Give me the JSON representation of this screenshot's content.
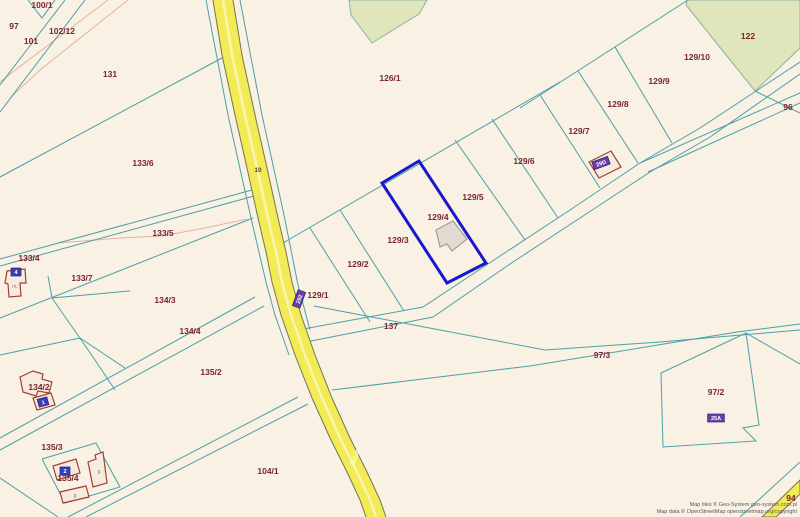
{
  "canvas": {
    "width": 800,
    "height": 517
  },
  "colors": {
    "background": "#f8f1e4",
    "parcel_line": "#4aa0a8",
    "path_line": "#e4b2a2",
    "road_fill": "#f2eb55",
    "road_edge": "#76764f",
    "road_center": "#f9f5b0",
    "label": "#7b2433",
    "highlight": "#1818cc",
    "green_fill": "#e1e5bc",
    "green_edge": "#8ab4a0",
    "building_gray_fill": "#e0dcd4",
    "building_gray_edge": "#a59c90",
    "building_red_fill": "#f7ebdf",
    "building_red_edge": "#a04030",
    "badge_blue": "#3a3fb8",
    "badge_purple": "#6b3fa8"
  },
  "parcel_labels": [
    {
      "text": "100/1",
      "x": 42,
      "y": 5
    },
    {
      "text": "97",
      "x": 14,
      "y": 26
    },
    {
      "text": "102/12",
      "x": 62,
      "y": 31
    },
    {
      "text": "101",
      "x": 31,
      "y": 41
    },
    {
      "text": "131",
      "x": 110,
      "y": 74
    },
    {
      "text": "126/1",
      "x": 390,
      "y": 78
    },
    {
      "text": "122",
      "x": 748,
      "y": 36
    },
    {
      "text": "129/10",
      "x": 697,
      "y": 57
    },
    {
      "text": "129/9",
      "x": 659,
      "y": 81
    },
    {
      "text": "129/8",
      "x": 618,
      "y": 104
    },
    {
      "text": "96",
      "x": 788,
      "y": 107
    },
    {
      "text": "129/7",
      "x": 579,
      "y": 131
    },
    {
      "text": "133/6",
      "x": 143,
      "y": 163
    },
    {
      "text": "129/6",
      "x": 524,
      "y": 161
    },
    {
      "text": "129/5",
      "x": 473,
      "y": 197
    },
    {
      "text": "129/4",
      "x": 438,
      "y": 217
    },
    {
      "text": "133/5",
      "x": 163,
      "y": 233
    },
    {
      "text": "129/3",
      "x": 398,
      "y": 240
    },
    {
      "text": "133/4",
      "x": 29,
      "y": 258
    },
    {
      "text": "129/2",
      "x": 358,
      "y": 264
    },
    {
      "text": "133/7",
      "x": 82,
      "y": 278
    },
    {
      "text": "129/1",
      "x": 318,
      "y": 295
    },
    {
      "text": "134/3",
      "x": 165,
      "y": 300
    },
    {
      "text": "137",
      "x": 391,
      "y": 326
    },
    {
      "text": "134/4",
      "x": 190,
      "y": 331
    },
    {
      "text": "97/3",
      "x": 602,
      "y": 355
    },
    {
      "text": "135/2",
      "x": 211,
      "y": 372
    },
    {
      "text": "134/2",
      "x": 39,
      "y": 387
    },
    {
      "text": "97/2",
      "x": 716,
      "y": 392
    },
    {
      "text": "135/3",
      "x": 52,
      "y": 447
    },
    {
      "text": "104/1",
      "x": 268,
      "y": 471
    },
    {
      "text": "135/4",
      "x": 68,
      "y": 478
    },
    {
      "text": "94",
      "x": 791,
      "y": 498
    }
  ],
  "road_labels": [
    {
      "text": "10",
      "x": 258,
      "y": 172,
      "rot": 0,
      "color": "#4a3f2f"
    },
    {
      "text": "101/4",
      "x": 357,
      "y": 459,
      "rot": -65,
      "color": "#fdfdf2"
    }
  ],
  "badges": [
    {
      "text": "4",
      "x": 16,
      "y": 272,
      "type": "blue",
      "rot": 0
    },
    {
      "text": "1",
      "x": 43,
      "y": 402,
      "type": "blue",
      "rot": -15
    },
    {
      "text": "2",
      "x": 65,
      "y": 471,
      "type": "blue",
      "rot": 0
    },
    {
      "text": "292",
      "x": 299,
      "y": 299,
      "type": "purple",
      "rot": -70
    },
    {
      "text": "29D",
      "x": 601,
      "y": 163,
      "type": "purple",
      "rot": -20
    },
    {
      "text": "25A",
      "x": 716,
      "y": 418,
      "type": "purple",
      "rot": 0
    }
  ],
  "building_letters": [
    {
      "text": "m.",
      "x": 15,
      "y": 288
    },
    {
      "text": "g",
      "x": 99,
      "y": 473
    },
    {
      "text": "g",
      "x": 75,
      "y": 497
    }
  ],
  "green_areas": [
    [
      [
        349,
        0
      ],
      [
        427,
        0
      ],
      [
        419,
        14
      ],
      [
        372,
        43
      ],
      [
        351,
        15
      ]
    ],
    [
      [
        687,
        0
      ],
      [
        800,
        0
      ],
      [
        800,
        48
      ],
      [
        755,
        91
      ],
      [
        686,
        5
      ]
    ]
  ],
  "teal_lines": [
    [
      [
        28,
        0
      ],
      [
        42,
        18
      ],
      [
        55,
        0
      ]
    ],
    [
      [
        65,
        0
      ],
      [
        0,
        85
      ]
    ],
    [
      [
        85,
        0
      ],
      [
        0,
        112
      ]
    ],
    [
      [
        222,
        58
      ],
      [
        0,
        177
      ]
    ],
    [
      [
        252,
        190
      ],
      [
        0,
        259
      ]
    ],
    [
      [
        254,
        196
      ],
      [
        0,
        266
      ]
    ],
    [
      [
        253,
        218
      ],
      [
        0,
        318
      ]
    ],
    [
      [
        48,
        276
      ],
      [
        52,
        298
      ]
    ],
    [
      [
        52,
        298
      ],
      [
        130,
        291
      ]
    ],
    [
      [
        52,
        298
      ],
      [
        93,
        357
      ],
      [
        115,
        390
      ]
    ],
    [
      [
        0,
        438
      ],
      [
        255,
        297
      ]
    ],
    [
      [
        0,
        450
      ],
      [
        264,
        306
      ]
    ],
    [
      [
        0,
        355
      ],
      [
        80,
        338
      ]
    ],
    [
      [
        80,
        338
      ],
      [
        125,
        368
      ]
    ],
    [
      [
        68,
        517
      ],
      [
        298,
        397
      ]
    ],
    [
      [
        86,
        517
      ],
      [
        308,
        404
      ]
    ],
    [
      [
        0,
        478
      ],
      [
        58,
        517
      ]
    ],
    [
      [
        42,
        459
      ],
      [
        96,
        443
      ],
      [
        120,
        487
      ],
      [
        65,
        503
      ],
      [
        42,
        459
      ]
    ],
    [
      [
        298,
        330
      ],
      [
        423,
        307
      ],
      [
        500,
        256
      ],
      [
        570,
        210
      ],
      [
        640,
        163
      ],
      [
        700,
        128
      ],
      [
        800,
        62
      ]
    ],
    [
      [
        306,
        342
      ],
      [
        433,
        317
      ],
      [
        510,
        264
      ],
      [
        580,
        218
      ],
      [
        650,
        172
      ],
      [
        710,
        137
      ],
      [
        800,
        74
      ]
    ],
    [
      [
        640,
        163
      ],
      [
        800,
        93
      ]
    ],
    [
      [
        648,
        172
      ],
      [
        800,
        103
      ]
    ],
    [
      [
        314,
        306
      ],
      [
        440,
        330
      ],
      [
        545,
        350
      ],
      [
        660,
        342
      ],
      [
        800,
        330
      ]
    ],
    [
      [
        332,
        390
      ],
      [
        530,
        366
      ],
      [
        737,
        332
      ],
      [
        800,
        324
      ]
    ],
    [
      [
        661,
        373
      ],
      [
        746,
        333
      ],
      [
        759,
        425
      ],
      [
        743,
        428
      ],
      [
        756,
        441
      ],
      [
        663,
        447
      ],
      [
        661,
        373
      ]
    ],
    [
      [
        746,
        333
      ],
      [
        800,
        364
      ]
    ],
    [
      [
        283,
        243
      ],
      [
        560,
        82
      ]
    ],
    [
      [
        520,
        108
      ],
      [
        688,
        0
      ]
    ],
    [
      [
        310,
        228
      ],
      [
        370,
        322
      ]
    ],
    [
      [
        340,
        210
      ],
      [
        404,
        311
      ]
    ],
    [
      [
        455,
        140
      ],
      [
        525,
        240
      ]
    ],
    [
      [
        492,
        119
      ],
      [
        558,
        218
      ]
    ],
    [
      [
        540,
        95
      ],
      [
        600,
        188
      ]
    ],
    [
      [
        578,
        71
      ],
      [
        638,
        163
      ]
    ],
    [
      [
        615,
        47
      ],
      [
        672,
        143
      ]
    ],
    [
      [
        206,
        0
      ],
      [
        228,
        115
      ],
      [
        251,
        218
      ],
      [
        266,
        282
      ],
      [
        275,
        315
      ],
      [
        289,
        355
      ]
    ],
    [
      [
        240,
        0
      ],
      [
        262,
        115
      ],
      [
        284,
        215
      ],
      [
        298,
        285
      ],
      [
        310,
        330
      ]
    ],
    [
      [
        755,
        91
      ],
      [
        800,
        113
      ]
    ],
    [
      [
        740,
        517
      ],
      [
        800,
        462
      ]
    ]
  ],
  "pink_lines": [
    [
      [
        108,
        0
      ],
      [
        18,
        68
      ],
      [
        0,
        82
      ]
    ],
    [
      [
        128,
        0
      ],
      [
        40,
        70
      ],
      [
        10,
        98
      ]
    ],
    [
      [
        58,
        243
      ],
      [
        120,
        238
      ],
      [
        162,
        236
      ],
      [
        205,
        228
      ],
      [
        247,
        219
      ]
    ]
  ],
  "road": {
    "left": [
      [
        213,
        0
      ],
      [
        222,
        55
      ],
      [
        235,
        115
      ],
      [
        247,
        168
      ],
      [
        258,
        218
      ],
      [
        266,
        252
      ],
      [
        272,
        282
      ],
      [
        281,
        315
      ],
      [
        295,
        355
      ],
      [
        312,
        398
      ],
      [
        330,
        438
      ],
      [
        347,
        472
      ],
      [
        360,
        500
      ],
      [
        366,
        517
      ]
    ],
    "right": [
      [
        233,
        0
      ],
      [
        242,
        55
      ],
      [
        255,
        115
      ],
      [
        267,
        168
      ],
      [
        278,
        218
      ],
      [
        286,
        252
      ],
      [
        292,
        282
      ],
      [
        301,
        315
      ],
      [
        315,
        355
      ],
      [
        332,
        398
      ],
      [
        350,
        438
      ],
      [
        367,
        472
      ],
      [
        380,
        500
      ],
      [
        386,
        517
      ]
    ]
  },
  "corner_road": [
    [
      762,
      517
    ],
    [
      800,
      480
    ],
    [
      800,
      494
    ],
    [
      776,
      517
    ]
  ],
  "highlight_parcel": [
    [
      382,
      183
    ],
    [
      419,
      161
    ],
    [
      486,
      263
    ],
    [
      447,
      283
    ]
  ],
  "buildings": [
    {
      "style": "gray",
      "points": [
        [
          436,
          230
        ],
        [
          453,
          221
        ],
        [
          467,
          239
        ],
        [
          452,
          251
        ],
        [
          447,
          244
        ],
        [
          440,
          247
        ]
      ]
    },
    {
      "style": "red",
      "points": [
        [
          589,
          162
        ],
        [
          611,
          151
        ],
        [
          621,
          167
        ],
        [
          599,
          178
        ]
      ]
    },
    {
      "style": "red",
      "points": [
        [
          7,
          271
        ],
        [
          25,
          269
        ],
        [
          26,
          283
        ],
        [
          20,
          283
        ],
        [
          21,
          296
        ],
        [
          9,
          297
        ],
        [
          8,
          284
        ],
        [
          5,
          283
        ]
      ]
    },
    {
      "style": "red",
      "points": [
        [
          20,
          377
        ],
        [
          33,
          371
        ],
        [
          43,
          374
        ],
        [
          42,
          379
        ],
        [
          52,
          382
        ],
        [
          49,
          393
        ],
        [
          38,
          391
        ],
        [
          36,
          396
        ],
        [
          23,
          392
        ]
      ]
    },
    {
      "style": "red",
      "points": [
        [
          33,
          398
        ],
        [
          51,
          393
        ],
        [
          55,
          405
        ],
        [
          37,
          410
        ]
      ]
    },
    {
      "style": "red",
      "points": [
        [
          53,
          466
        ],
        [
          76,
          459
        ],
        [
          80,
          473
        ],
        [
          57,
          480
        ]
      ]
    },
    {
      "style": "red",
      "points": [
        [
          88,
          462
        ],
        [
          96,
          459
        ],
        [
          95,
          455
        ],
        [
          103,
          452
        ],
        [
          107,
          483
        ],
        [
          93,
          487
        ]
      ]
    },
    {
      "style": "red",
      "points": [
        [
          60,
          492
        ],
        [
          86,
          486
        ],
        [
          89,
          497
        ],
        [
          63,
          503
        ]
      ]
    }
  ],
  "attribution": {
    "line1": "Map tiles © Geo-System geo-system.com.pl",
    "line2": "Map data © OpenStreetMap openstreetmap.org/copyright"
  }
}
